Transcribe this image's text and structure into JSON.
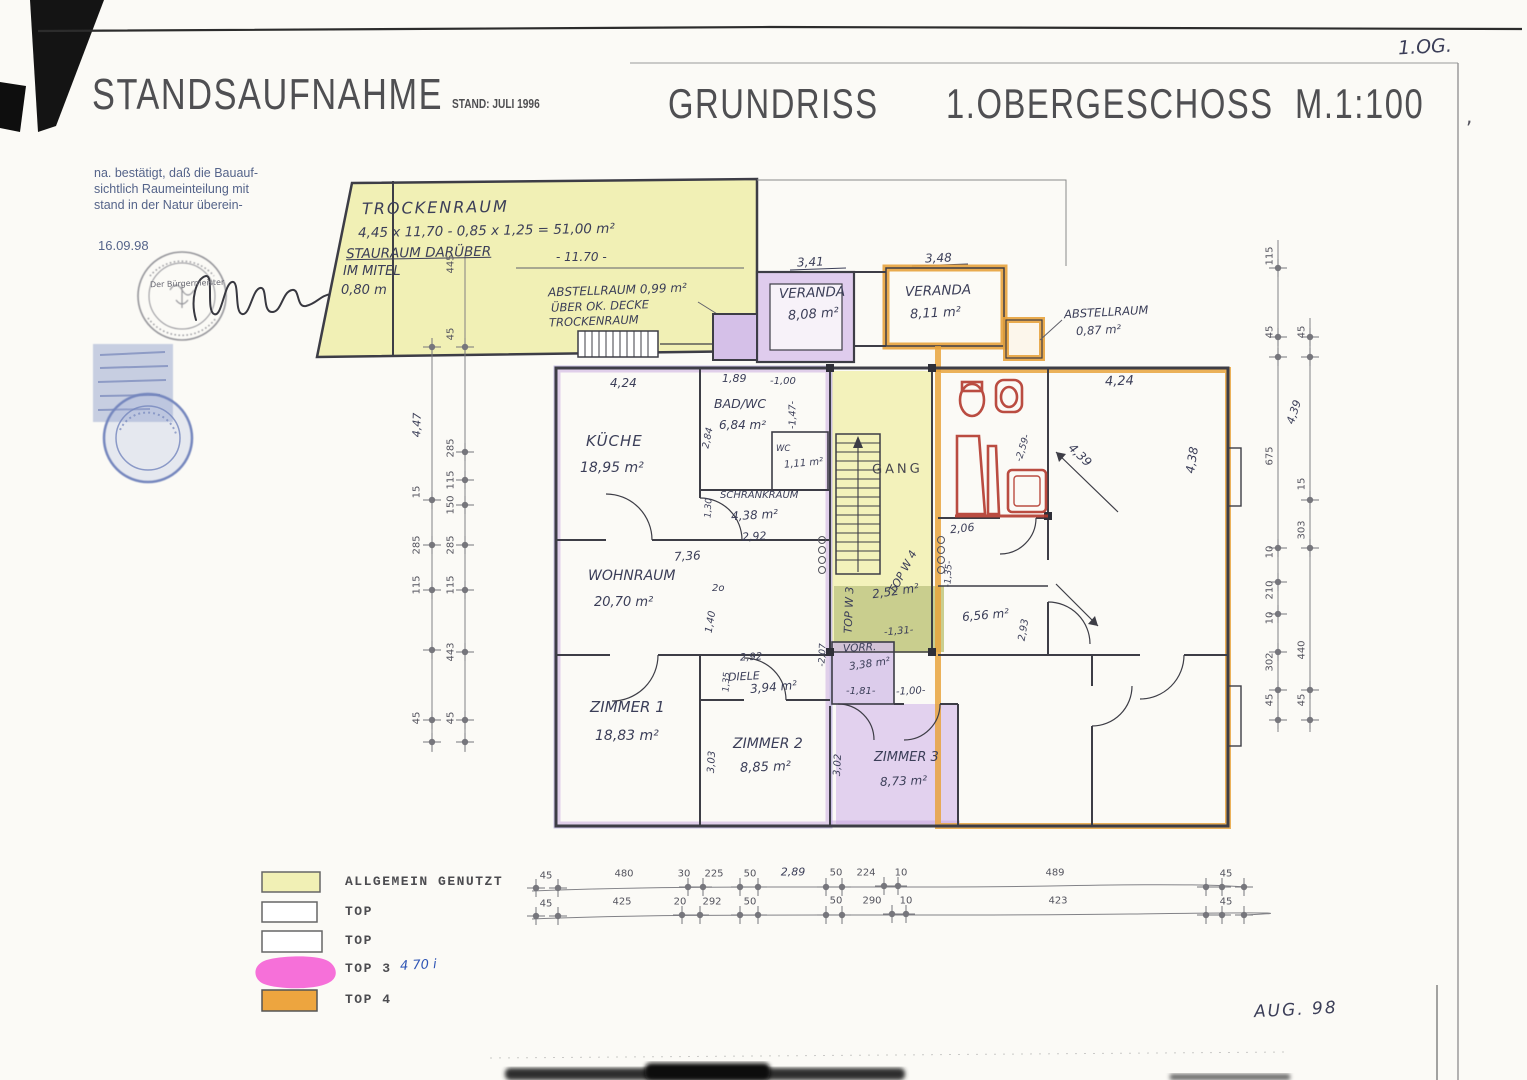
{
  "sheet": {
    "corner_note": "1.OG.",
    "title": "STANDSAUFNAHME",
    "status": "STAND: JULI 1996",
    "drawing_type": "GRUNDRISS",
    "floor_scale": "1.OBERGESCHOSS  M.1:100",
    "date_note": "AUG. 98",
    "frame_mark": ","
  },
  "certification": {
    "line1": "na. bestätigt, daß die Bauauf-",
    "line2": "sichtlich Raumeinteilung mit",
    "line3": "stand in der Natur überein-",
    "date": "16.09.98",
    "stamp_title": "Der Bürgermeister"
  },
  "trocken": {
    "name": "TROCKENRAUM",
    "calc": "4,45 x 11,70 - 0,85 x 1,25 = 51,00 m²",
    "note1": "STAURAUM DARÜBER",
    "note2": "IM MITEL",
    "note3": "0,80 m",
    "width_dim": "- 11.70 -",
    "abst1": "ABSTELLRAUM 0,99 m²",
    "abst2": "ÜBER OK. DECKE",
    "abst3": "TROCKENRAUM"
  },
  "rooms": {
    "veranda1": {
      "name": "VERANDA",
      "area": "8,08 m²"
    },
    "veranda2": {
      "name": "VERANDA",
      "area": "8,11 m²"
    },
    "abstell": {
      "name": "ABSTELLRAUM",
      "area": "0,87 m²"
    },
    "kueche": {
      "name": "KÜCHE",
      "area": "18,95 m²"
    },
    "bad": {
      "name": "BAD/WC",
      "area": "6,84 m²"
    },
    "wc": {
      "name": "WC",
      "area": "1,11 m²"
    },
    "schrank": {
      "name": "SCHRANKRAUM",
      "area": "4,38 m²"
    },
    "gang": {
      "name": "GANG"
    },
    "wohn": {
      "name": "WOHNRAUM",
      "area": "20,70 m²"
    },
    "z1": {
      "name": "ZIMMER 1",
      "area": "18,83 m²"
    },
    "diele": {
      "name": "DIELE",
      "area": "3,94 m²"
    },
    "z2": {
      "name": "ZIMMER 2",
      "area": "8,85 m²"
    },
    "vorr": {
      "name": "VORR.",
      "area": "3,38 m²"
    },
    "z3": {
      "name": "ZIMMER 3",
      "area": "8,73 m²"
    },
    "w4": {
      "name": "TOP W 4",
      "area": "2,52 m²"
    },
    "w3": {
      "name": "TOP W 3"
    },
    "r656": {
      "area": "6,56 m²"
    }
  },
  "dims": {
    "v1": "3,41",
    "v2": "3,48",
    "k_top": "4,24",
    "bad_top": "1,89",
    "wc_top": "-1,00",
    "wc_side": "-1,47-",
    "bad_side": "2,84",
    "schr_side": "1,30",
    "schr_bot": "2,92",
    "wohn_top": "7,36",
    "nub": "2o",
    "w140": "1,40",
    "diele_top": "2,92",
    "diele_side": "1,35",
    "z2_side": "3,03",
    "z3_side": "3,02",
    "vorr_w": "-1,81-",
    "vorr_side": "-2,07",
    "z3_door": "-1,00-",
    "w4_door": "-1,31-",
    "r_206": "2,06",
    "r_135": "-1,35-",
    "r_259": "-2,59-",
    "tr_top": "4,24",
    "tr_diag": "4,39",
    "tr_side": "4,38",
    "r656_side": "2,93",
    "chain_439": "4,39"
  },
  "chains": {
    "left_outer": [
      "4,47",
      "15",
      "285",
      "115",
      "45"
    ],
    "left_inner": [
      "445",
      "45",
      "285",
      "115",
      "150",
      "285",
      "115",
      "443",
      "45"
    ],
    "right_outer": [
      "115",
      "45",
      "675",
      "10",
      "210",
      "10",
      "302",
      "45"
    ],
    "right_inner": [
      "45",
      "15",
      "303",
      "440",
      "45"
    ],
    "bottom1": [
      "45",
      "480",
      "30",
      "225",
      "50",
      "2,89",
      "50",
      "224",
      "10",
      "489",
      "45"
    ],
    "bottom2": [
      "45",
      "425",
      "20",
      "292",
      "50",
      "50",
      "290",
      "10",
      "423",
      "45"
    ]
  },
  "legend": {
    "i1": "ALLGEMEIN GENUTZT",
    "i2": "TOP",
    "i3": "TOP",
    "i4": "TOP 3",
    "i4_hw": "4 70 i",
    "i5": "TOP 4"
  }
}
